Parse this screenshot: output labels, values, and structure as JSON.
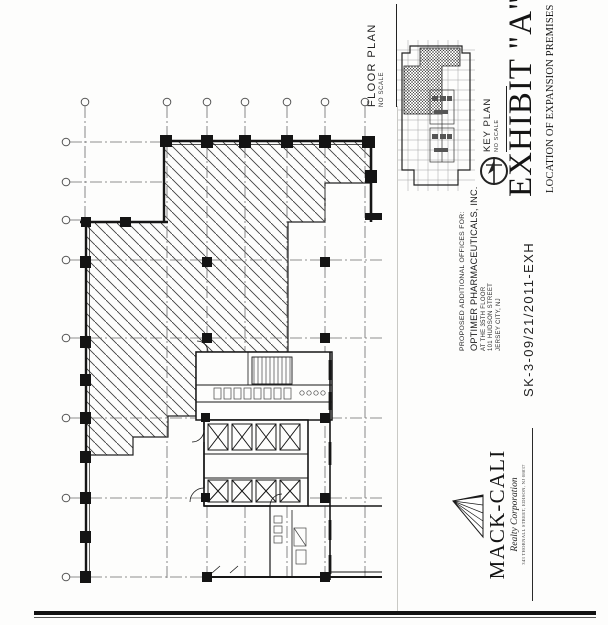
{
  "sheet": {
    "floor_plan": {
      "title": "FLOOR PLAN",
      "scale": "NO SCALE"
    },
    "key_plan": {
      "title": "KEY PLAN",
      "scale": "NO SCALE"
    },
    "exhibit": {
      "title": "EXHIBIT \"A\"",
      "subtitle": "LOCATION OF EXPANSION PREMISES"
    },
    "project": {
      "lines": [
        "PROPOSED ADDITIONAL OFFICES FOR:",
        "OPTIMER PHARMACEUTICALS, INC.",
        "AT THE 35TH FLOOR",
        "101 HUDSON STREET",
        "JERSEY CITY, NJ"
      ]
    },
    "sketch_number": "SK-3-09/21/2011-EXH",
    "logo": {
      "name": "MACK-CALI",
      "subtitle": "Realty Corporation",
      "address": "343 THORNALL STREET, EDISON, NJ 08837"
    },
    "icons": {
      "north_arrow": "compass-north-icon",
      "logo_mark": "mack-cali-pyramid-icon"
    },
    "colors": {
      "ink": "#1d1d1d",
      "paper": "#fdfdfc",
      "hatch": "#3f3f3f"
    }
  }
}
